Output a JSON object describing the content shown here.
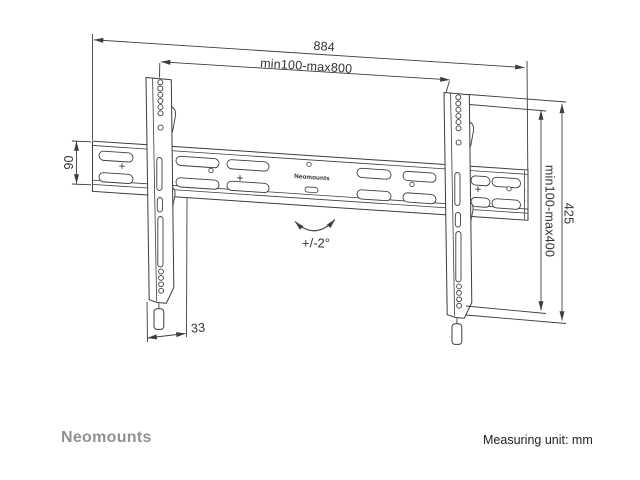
{
  "footer": {
    "brand": "Neomounts",
    "measuring_unit": "Measuring unit: mm"
  },
  "drawing": {
    "rail_label": "Neomounts",
    "tilt_label": "+/-2°",
    "dims": {
      "total_width": "884",
      "width_range": "min100-max800",
      "rail_height": "90",
      "height_range": "min100-max400",
      "bracket_height": "425",
      "depth": "33"
    },
    "colors": {
      "line": "#3d3d3d",
      "text": "#333333",
      "brand": "#8e9293",
      "unit_text": "#202020"
    }
  }
}
